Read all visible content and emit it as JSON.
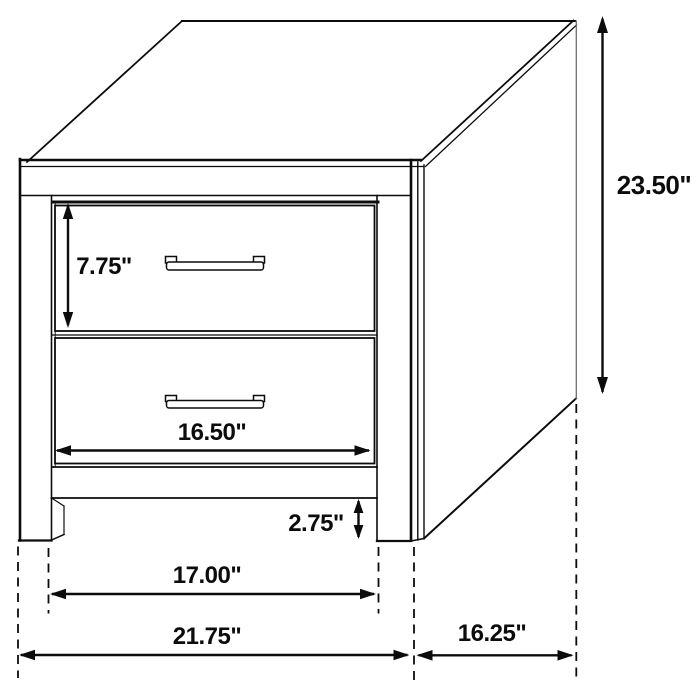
{
  "diagram": {
    "subject": "two-drawer-nightstand-dimension-drawing",
    "colors": {
      "line": "#0c0c0c",
      "background": "#ffffff"
    },
    "dimensions": {
      "overall_height": "23.50\"",
      "top_drawer_height": "7.75\"",
      "drawer_width": "16.50\"",
      "floor_clearance": "2.75\"",
      "inner_leg_span": "17.00\"",
      "overall_width": "21.75\"",
      "overall_depth": "16.25\""
    }
  }
}
